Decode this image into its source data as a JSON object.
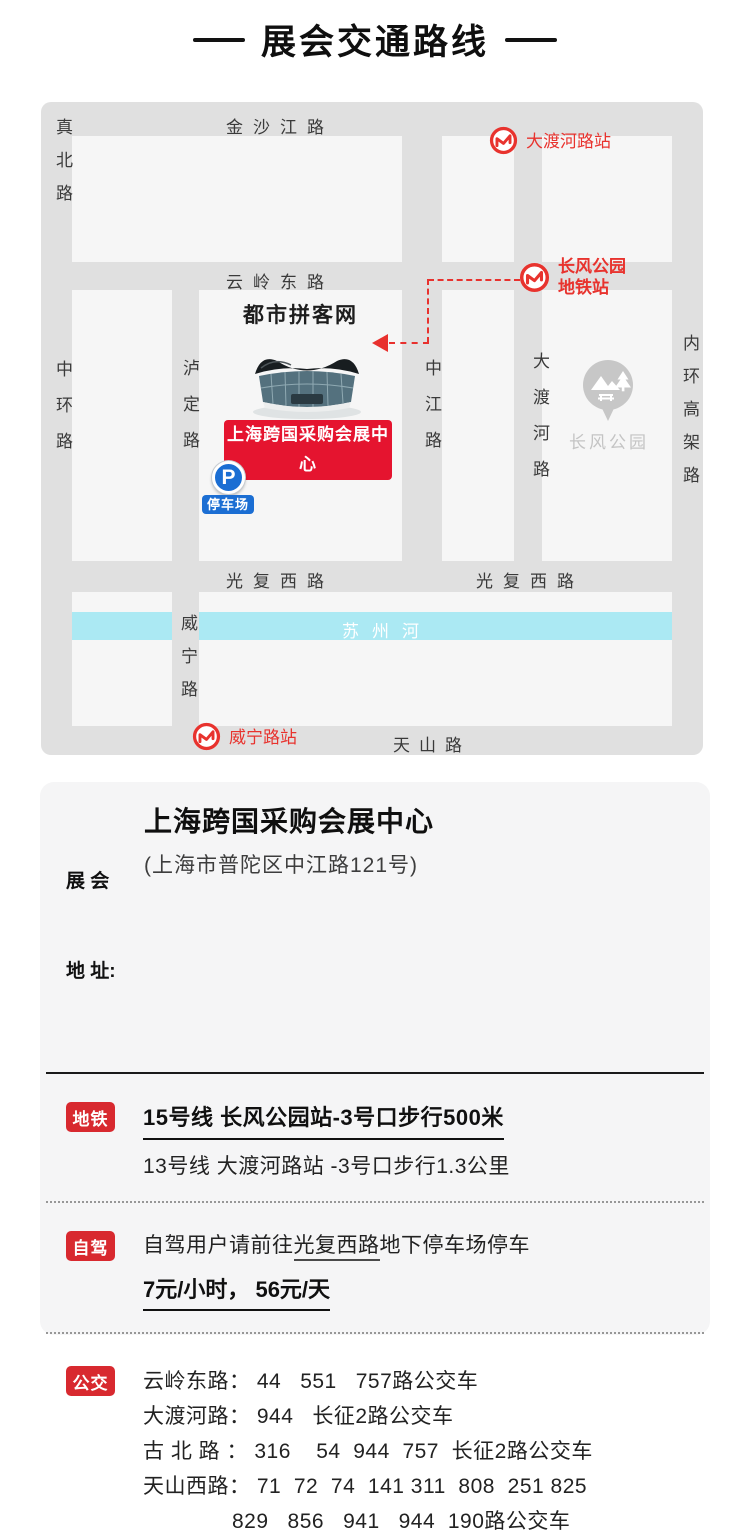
{
  "title": "展会交通路线",
  "map": {
    "road_labels": {
      "jinshajiang_rd": "金沙江路",
      "zhenbei_rd": "真北路",
      "yunlingdong_rd": "云岭东路",
      "zhonghuan_rd": "中环路",
      "luding_rd": "泸定路",
      "zhongjiang_rd": "中江路",
      "daduhe_rd": "大渡河路",
      "neihuangaojia_rd": "内环高架路",
      "guangfuxi_rd_left": "光复西路",
      "guangfuxi_rd_right": "光复西路",
      "weining_rd": "威宁路",
      "tianshan_rd": "天山路",
      "suzhou_river": "苏州河"
    },
    "stations": {
      "daduhe_station": "大渡河路站",
      "changfeng_station_line1": "长风公园",
      "changfeng_station_line2": "地铁站",
      "weining_station": "威宁路站"
    },
    "venue": {
      "site_label": "都市拼客网",
      "venue_badge": "上海跨国采购会展中心",
      "parking_letter": "P",
      "parking_label": "停车场"
    },
    "park_label": "长风公园"
  },
  "info": {
    "address": {
      "label_line1": "展 会",
      "label_line2": "地 址:",
      "name": "上海跨国采购会展中心",
      "detail": "(上海市普陀区中江路121号)"
    },
    "metro": {
      "badge": "地铁",
      "line1": "15号线 长风公园站-3号口步行500米",
      "line2": "13号线 大渡河路站 -3号口步行1.3公里"
    },
    "driving": {
      "badge": "自驾",
      "line1_prefix": "自驾用户请前往",
      "line1_highlight": "光复西路",
      "line1_suffix": "地下停车场停车",
      "line2": "7元/小时， 56元/天"
    },
    "bus": {
      "badge": "公交",
      "lines": [
        "云岭东路： 44   551   757路公交车",
        "大渡河路： 944   长征2路公交车",
        "古 北 路 ： 316    54  944  757  长征2路公交车",
        "天山西路： 71  72  74  141 311  808  251 825",
        "829   856   941   944  190路公交车"
      ]
    }
  },
  "colors": {
    "badge_red": "#d8292f",
    "station_red": "#e8332e",
    "venue_badge_red": "#e5142f",
    "parking_blue": "#1b6ed3",
    "river_blue": "#abe9f3",
    "road_gray": "#e0e0e0",
    "block_gray": "#f6f6f6"
  }
}
